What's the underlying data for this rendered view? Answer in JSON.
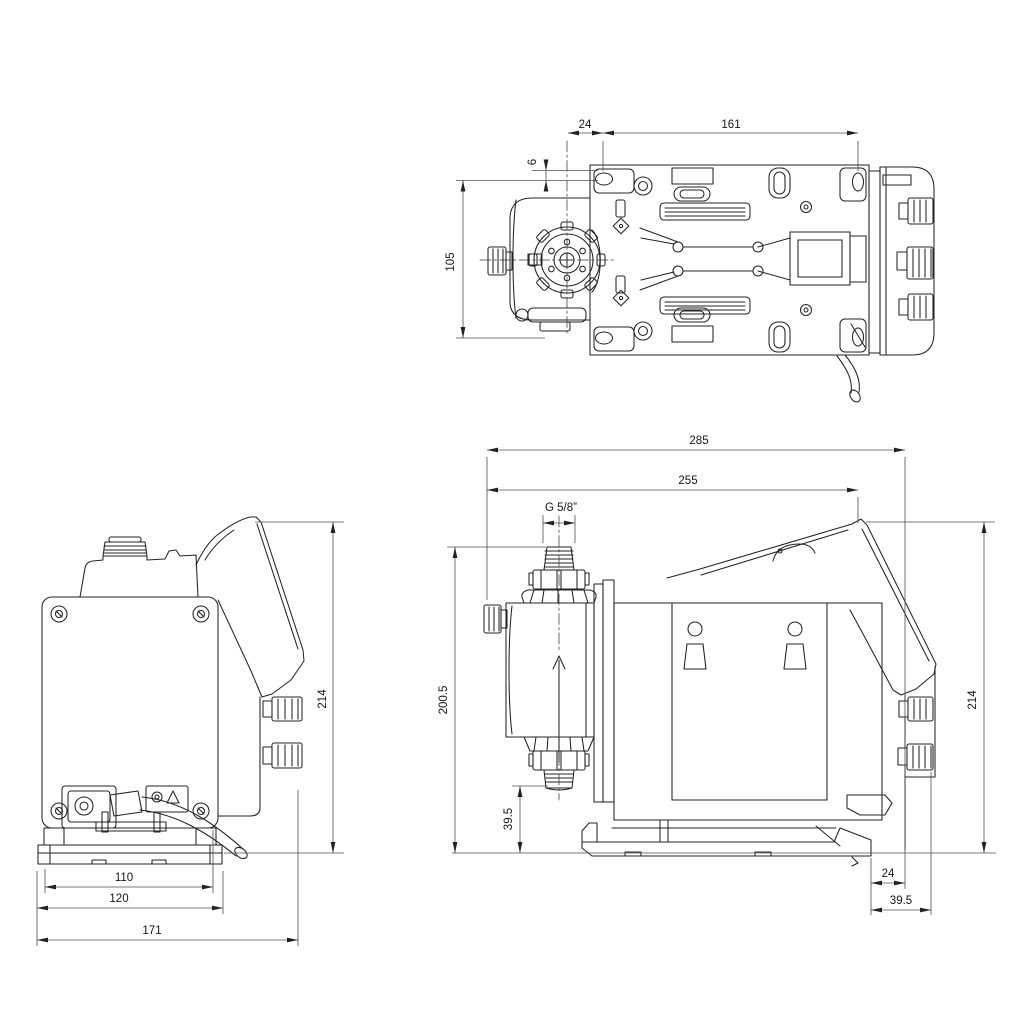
{
  "drawing": {
    "kind": "dimensional-drawing",
    "units": "mm",
    "colors": {
      "object_line": "#232323",
      "dimension_line": "#4f4f4f",
      "background": "#ffffff"
    },
    "views": {
      "top": {
        "dims": {
          "d24": "24",
          "d161": "161",
          "d6": "6",
          "d105": "105"
        }
      },
      "rear": {
        "dims": {
          "d214": "214",
          "d110": "110",
          "d120": "120",
          "d171": "171"
        }
      },
      "side": {
        "dims": {
          "d285": "285",
          "d255": "255",
          "thread": "G 5/8”",
          "d200_5": "200.5",
          "d39_5_upper": "39.5",
          "d24": "24",
          "d39_5_lower": "39.5",
          "d214": "214"
        }
      }
    }
  }
}
